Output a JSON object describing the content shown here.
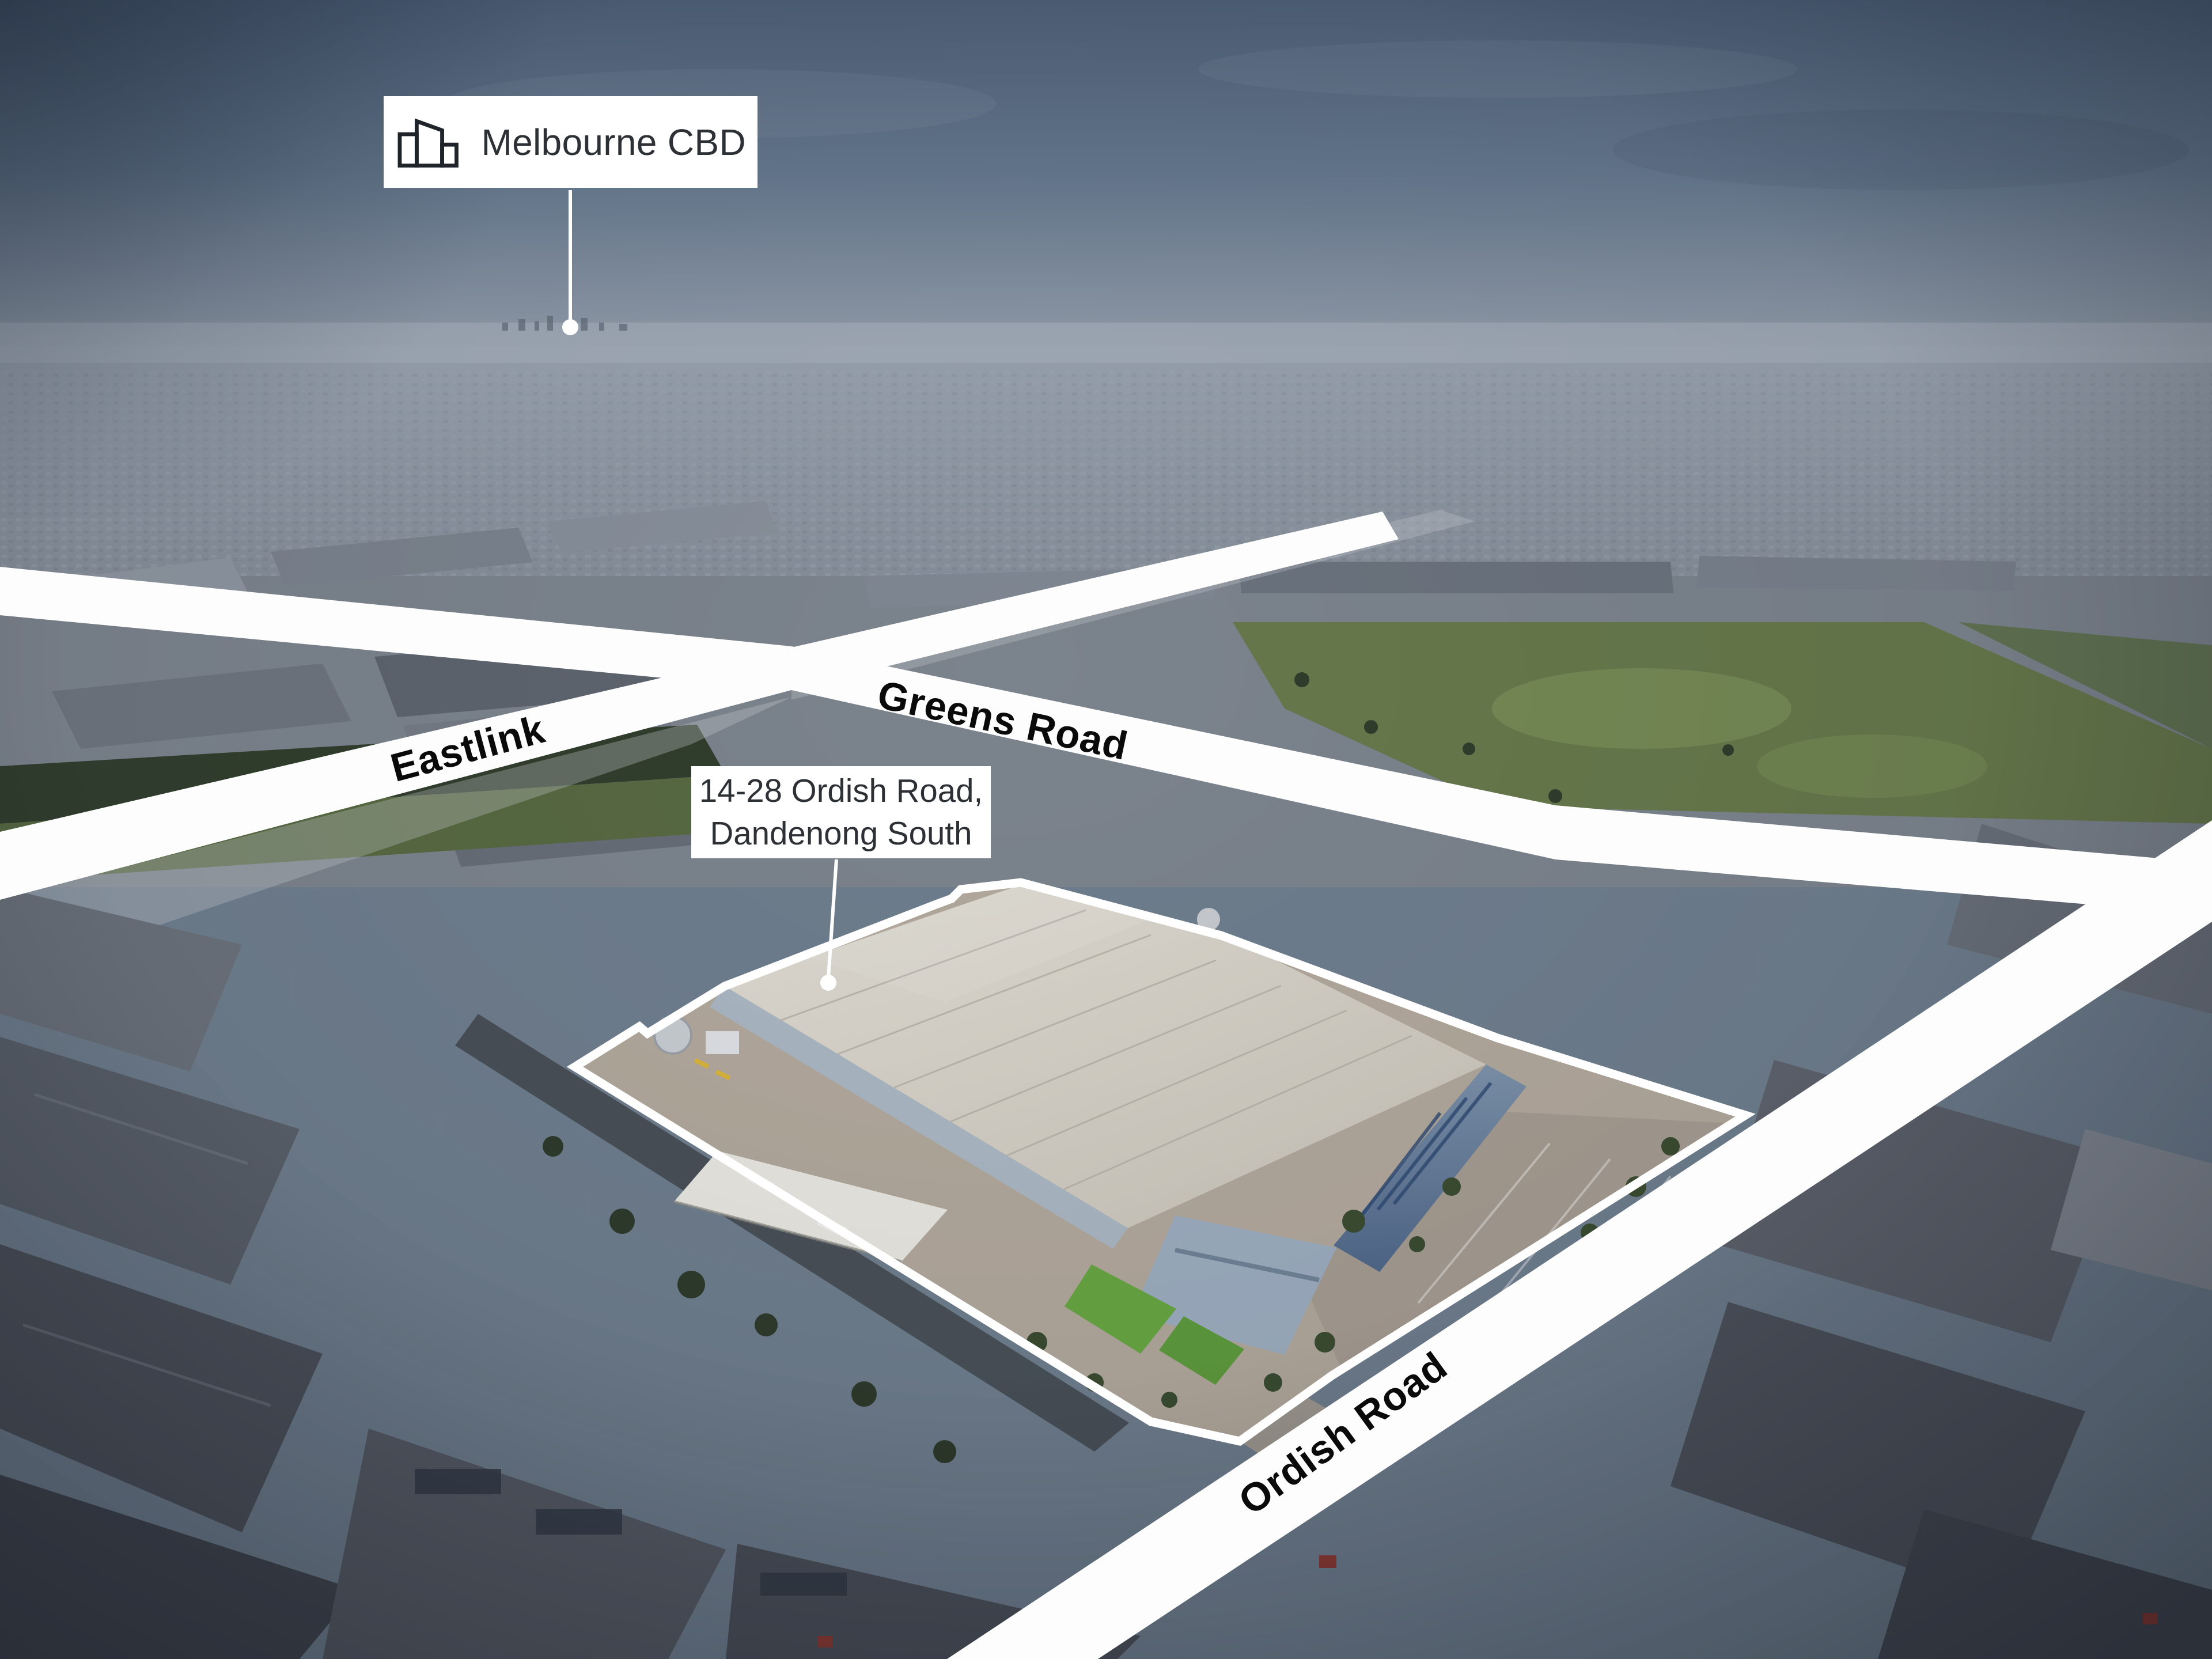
{
  "callouts": {
    "melbourne": {
      "label": "Melbourne CBD",
      "icon": "city-buildings-icon"
    },
    "property": {
      "line1": "14-28 Ordish Road,",
      "line2": "Dandenong South"
    }
  },
  "road_labels": {
    "eastlink": "Eastlink",
    "greens": "Greens Road",
    "ordish": "Ordish Road"
  },
  "colors": {
    "white": "#ffffff",
    "calloutText": "#2d3136",
    "roadText": "#0a0a0b",
    "overlayWhite": "#fdfdfd",
    "skyTop": "#4d5f77",
    "skyMid": "#64778d",
    "skyLow": "#8894a3",
    "hazeTop": "#9ca6b1",
    "suburb": "#8b939e",
    "midBase": "#7b838d",
    "parkGreen": "#66784b",
    "fieldGreen": "#576942",
    "treeGreen": "#313e2d",
    "roofLight": "#dcd8cf",
    "roofShade": "#c9c4b9",
    "wallLight": "#aab7c3",
    "wallBlueA": "#7d92aa",
    "wallBlueB": "#4f6789",
    "concrete": "#b2a89c",
    "asphalt": "#a59b91",
    "lawnGreen": "#67a643",
    "canopyWhite": "#e9e7e1",
    "shedLight": "#868e99",
    "shedMid": "#6b717b",
    "shedDark": "#4c515b",
    "shedDeep": "#41454f"
  }
}
